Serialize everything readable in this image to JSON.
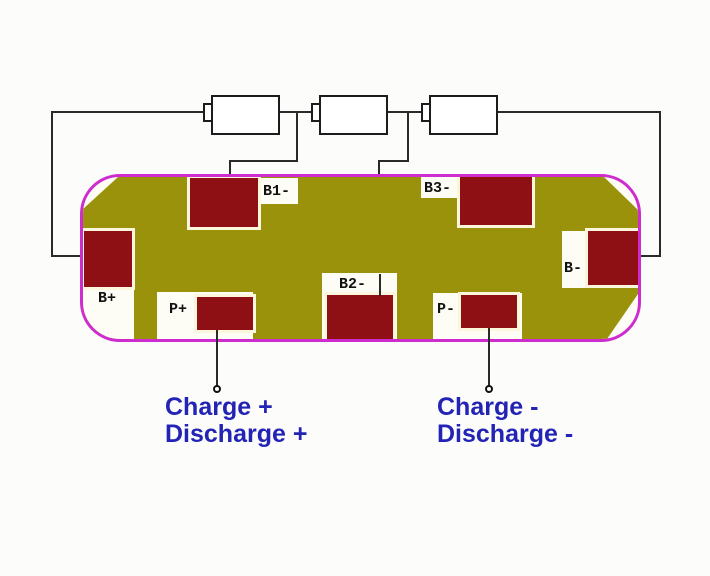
{
  "colors": {
    "background": "#fcfcfa",
    "wire": "#2a2a2a",
    "battery_border": "#1c1c1c",
    "battery_fill": "#ffffff",
    "board_border": "#cf2ccf",
    "board_fill": "#9a920a",
    "board_white": "#fdfdf6",
    "pad_fill": "#8e1014",
    "pad_edge": "#fbf6dc",
    "label_text": "#111111",
    "text_blue": "#2324b5"
  },
  "batteries": {
    "count": 3
  },
  "board": {
    "pads": {
      "b_plus": "B+",
      "b1_minus": "B1-",
      "b2_minus": "B2-",
      "b3_minus": "B3-",
      "b_minus": "B-",
      "p_plus": "P+",
      "p_minus": "P-"
    }
  },
  "annotations": {
    "positive": {
      "line1": "Charge +",
      "line2": "Discharge +"
    },
    "negative": {
      "line1": "Charge -",
      "line2": "Discharge -"
    }
  }
}
